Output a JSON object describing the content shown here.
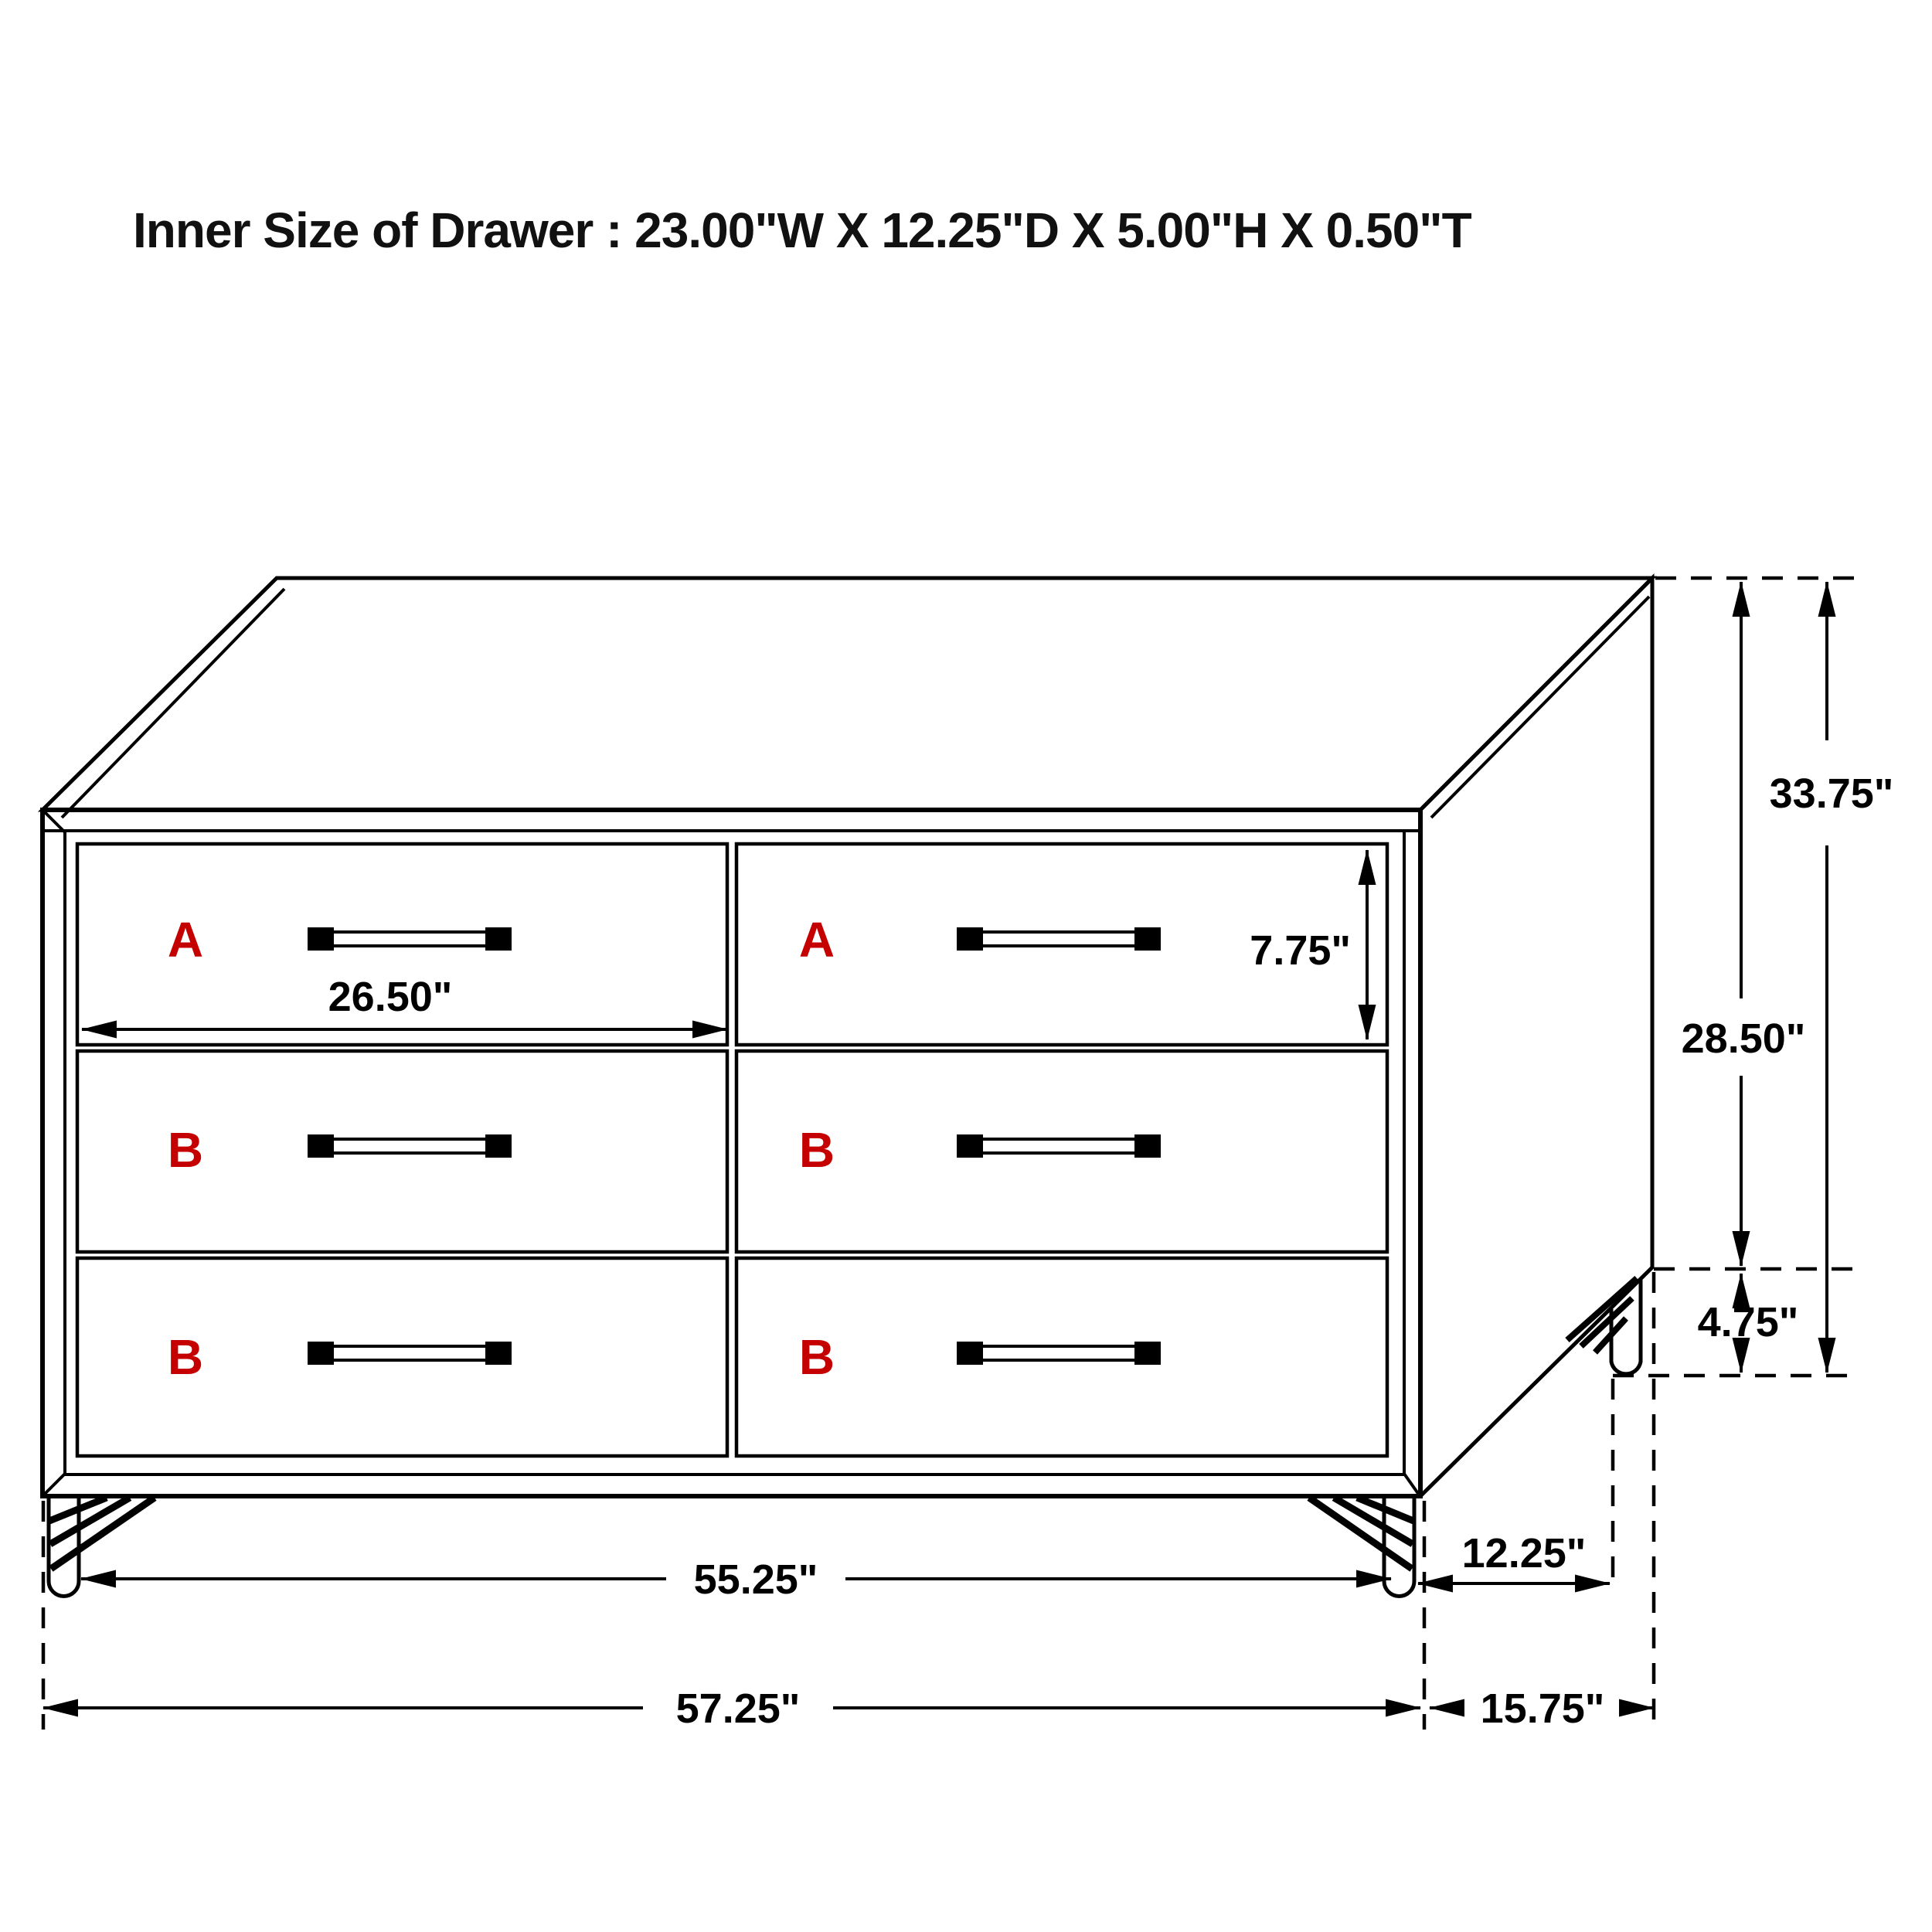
{
  "title": "Inner Size of Drawer : 23.00\"W X 12.25\"D X 5.00\"H X 0.50\"T",
  "drawers": [
    {
      "label": "A",
      "position": "top-left"
    },
    {
      "label": "A",
      "position": "top-right"
    },
    {
      "label": "B",
      "position": "middle-left"
    },
    {
      "label": "B",
      "position": "middle-right"
    },
    {
      "label": "B",
      "position": "bottom-left"
    },
    {
      "label": "B",
      "position": "bottom-right"
    }
  ],
  "dimensions": {
    "drawer_face_width": "26.50\"",
    "drawer_face_height": "7.75\"",
    "total_height": "33.75\"",
    "case_height": "28.50\"",
    "leg_height": "4.75\"",
    "leg_span_width": "55.25\"",
    "leg_span_depth": "12.25\"",
    "total_width": "57.25\"",
    "total_depth": "15.75\""
  },
  "inner_drawer_size": {
    "width": "23.00\"",
    "depth": "12.25\"",
    "height": "5.00\"",
    "thickness": "0.50\""
  },
  "colors": {
    "line": "#000000",
    "drawer_letter_red": "#c40000",
    "background": "#ffffff"
  }
}
